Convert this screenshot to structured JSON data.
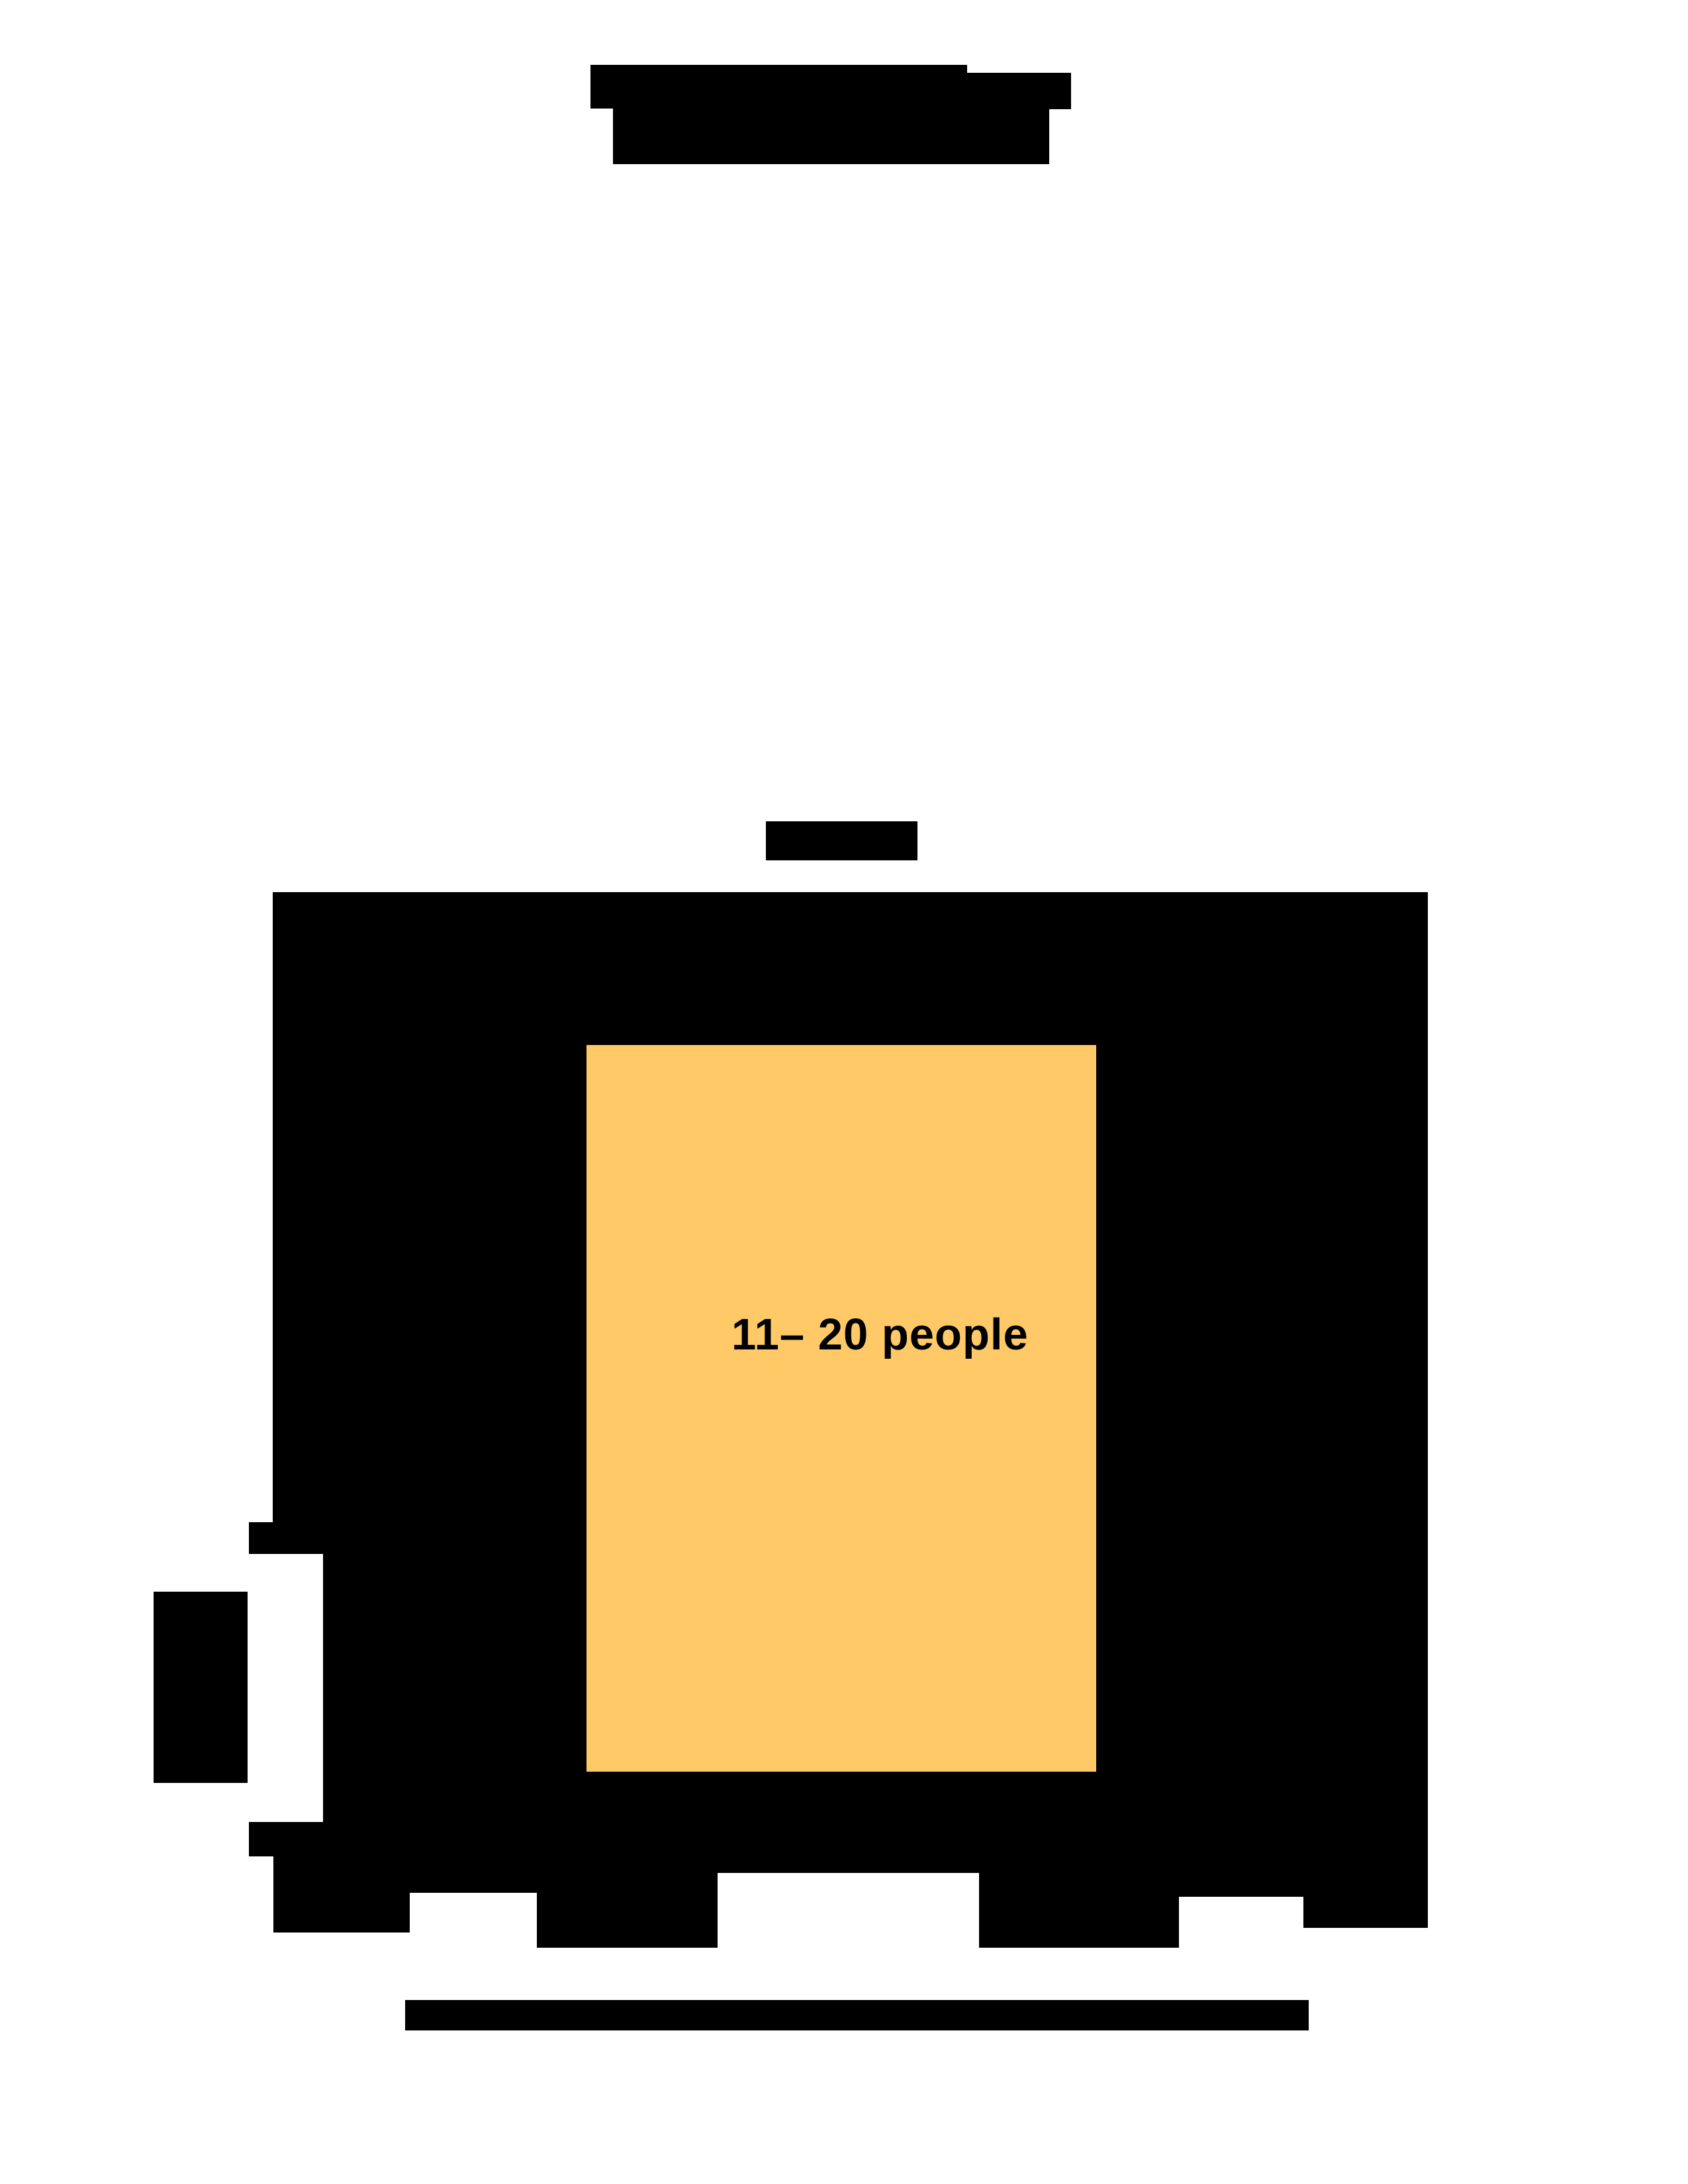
{
  "page": {
    "background": "#ffffff",
    "description": "redacted document page with highlighted figure region"
  },
  "colors": {
    "redaction_black": "#000000",
    "highlight_yellow": "#fec966"
  },
  "figure": {
    "inner_label": "11– 20 people"
  }
}
